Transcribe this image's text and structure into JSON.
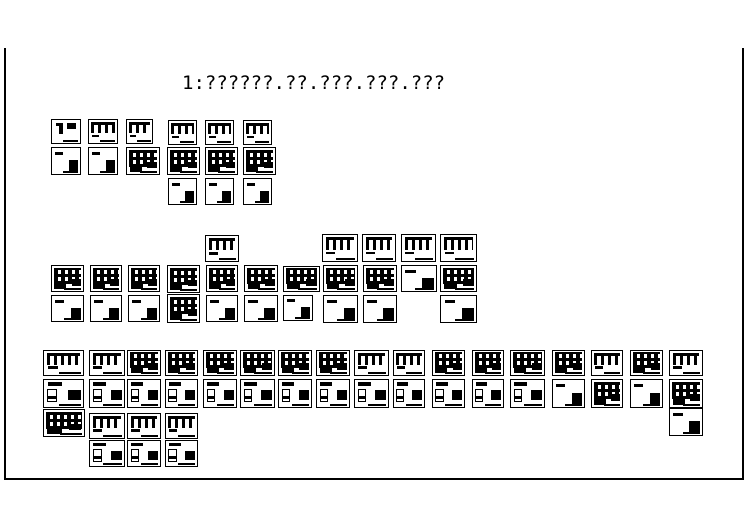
{
  "title": {
    "text": "1:??????.??.???.???.???"
  },
  "canvas": {
    "bg": "#ffffff",
    "line_color": "#000000"
  },
  "drawing": {
    "groups": [
      {
        "name": "group-1",
        "sheets": [
          {
            "x": 51,
            "y": 119,
            "w": 30,
            "h": 25,
            "v": "v5"
          },
          {
            "x": 88,
            "y": 119,
            "w": 30,
            "h": 25,
            "v": "v1"
          },
          {
            "x": 126,
            "y": 119,
            "w": 27,
            "h": 25,
            "v": "v1"
          },
          {
            "x": 168,
            "y": 120,
            "w": 29,
            "h": 25,
            "v": "v1"
          },
          {
            "x": 205,
            "y": 120,
            "w": 29,
            "h": 25,
            "v": "v1"
          },
          {
            "x": 243,
            "y": 120,
            "w": 29,
            "h": 25,
            "v": "v1"
          },
          {
            "x": 51,
            "y": 147,
            "w": 30,
            "h": 28,
            "v": "v3"
          },
          {
            "x": 88,
            "y": 147,
            "w": 30,
            "h": 28,
            "v": "v3"
          },
          {
            "x": 126,
            "y": 147,
            "w": 34,
            "h": 28,
            "v": "v2"
          },
          {
            "x": 167,
            "y": 147,
            "w": 33,
            "h": 28,
            "v": "v2"
          },
          {
            "x": 205,
            "y": 147,
            "w": 33,
            "h": 28,
            "v": "v2"
          },
          {
            "x": 243,
            "y": 147,
            "w": 33,
            "h": 28,
            "v": "v2"
          },
          {
            "x": 168,
            "y": 178,
            "w": 29,
            "h": 27,
            "v": "v3"
          },
          {
            "x": 205,
            "y": 178,
            "w": 29,
            "h": 27,
            "v": "v3"
          },
          {
            "x": 243,
            "y": 178,
            "w": 29,
            "h": 27,
            "v": "v3"
          }
        ]
      },
      {
        "name": "group-2",
        "sheets": [
          {
            "x": 205,
            "y": 235,
            "w": 34,
            "h": 27,
            "v": "v1"
          },
          {
            "x": 322,
            "y": 234,
            "w": 36,
            "h": 28,
            "v": "v1"
          },
          {
            "x": 362,
            "y": 234,
            "w": 34,
            "h": 28,
            "v": "v1"
          },
          {
            "x": 401,
            "y": 234,
            "w": 35,
            "h": 28,
            "v": "v1"
          },
          {
            "x": 440,
            "y": 234,
            "w": 37,
            "h": 28,
            "v": "v1"
          },
          {
            "x": 51,
            "y": 265,
            "w": 33,
            "h": 27,
            "v": "v2"
          },
          {
            "x": 90,
            "y": 265,
            "w": 32,
            "h": 27,
            "v": "v2"
          },
          {
            "x": 128,
            "y": 265,
            "w": 32,
            "h": 27,
            "v": "v2"
          },
          {
            "x": 167,
            "y": 265,
            "w": 33,
            "h": 28,
            "v": "v2"
          },
          {
            "x": 206,
            "y": 265,
            "w": 32,
            "h": 27,
            "v": "v2"
          },
          {
            "x": 244,
            "y": 265,
            "w": 34,
            "h": 27,
            "v": "v2"
          },
          {
            "x": 283,
            "y": 266,
            "w": 37,
            "h": 26,
            "v": "v2"
          },
          {
            "x": 323,
            "y": 265,
            "w": 35,
            "h": 27,
            "v": "v2"
          },
          {
            "x": 363,
            "y": 265,
            "w": 34,
            "h": 27,
            "v": "v2"
          },
          {
            "x": 401,
            "y": 265,
            "w": 36,
            "h": 27,
            "v": "v3"
          },
          {
            "x": 440,
            "y": 265,
            "w": 37,
            "h": 27,
            "v": "v2"
          },
          {
            "x": 51,
            "y": 295,
            "w": 33,
            "h": 27,
            "v": "v3"
          },
          {
            "x": 90,
            "y": 295,
            "w": 32,
            "h": 27,
            "v": "v3"
          },
          {
            "x": 128,
            "y": 295,
            "w": 32,
            "h": 27,
            "v": "v3"
          },
          {
            "x": 167,
            "y": 294,
            "w": 33,
            "h": 29,
            "v": "v2"
          },
          {
            "x": 206,
            "y": 295,
            "w": 32,
            "h": 27,
            "v": "v3"
          },
          {
            "x": 244,
            "y": 295,
            "w": 34,
            "h": 27,
            "v": "v3"
          },
          {
            "x": 283,
            "y": 295,
            "w": 30,
            "h": 26,
            "v": "v3"
          },
          {
            "x": 323,
            "y": 295,
            "w": 35,
            "h": 28,
            "v": "v3"
          },
          {
            "x": 363,
            "y": 295,
            "w": 34,
            "h": 28,
            "v": "v3"
          },
          {
            "x": 440,
            "y": 295,
            "w": 37,
            "h": 28,
            "v": "v3"
          }
        ]
      },
      {
        "name": "group-3",
        "sheets": [
          {
            "x": 43,
            "y": 350,
            "w": 41,
            "h": 26,
            "v": "v1"
          },
          {
            "x": 89,
            "y": 350,
            "w": 36,
            "h": 26,
            "v": "v1"
          },
          {
            "x": 127,
            "y": 350,
            "w": 34,
            "h": 26,
            "v": "v2"
          },
          {
            "x": 165,
            "y": 350,
            "w": 33,
            "h": 26,
            "v": "v2"
          },
          {
            "x": 203,
            "y": 350,
            "w": 34,
            "h": 26,
            "v": "v2"
          },
          {
            "x": 240,
            "y": 350,
            "w": 35,
            "h": 26,
            "v": "v2"
          },
          {
            "x": 278,
            "y": 350,
            "w": 34,
            "h": 26,
            "v": "v2"
          },
          {
            "x": 316,
            "y": 350,
            "w": 34,
            "h": 26,
            "v": "v2"
          },
          {
            "x": 354,
            "y": 350,
            "w": 35,
            "h": 26,
            "v": "v1"
          },
          {
            "x": 393,
            "y": 350,
            "w": 32,
            "h": 26,
            "v": "v1"
          },
          {
            "x": 432,
            "y": 350,
            "w": 33,
            "h": 26,
            "v": "v2"
          },
          {
            "x": 472,
            "y": 350,
            "w": 32,
            "h": 26,
            "v": "v2"
          },
          {
            "x": 510,
            "y": 350,
            "w": 35,
            "h": 26,
            "v": "v2"
          },
          {
            "x": 552,
            "y": 350,
            "w": 33,
            "h": 26,
            "v": "v2"
          },
          {
            "x": 591,
            "y": 350,
            "w": 32,
            "h": 26,
            "v": "v1"
          },
          {
            "x": 630,
            "y": 350,
            "w": 33,
            "h": 26,
            "v": "v2"
          },
          {
            "x": 669,
            "y": 350,
            "w": 34,
            "h": 26,
            "v": "v1"
          },
          {
            "x": 43,
            "y": 379,
            "w": 41,
            "h": 29,
            "v": "v4"
          },
          {
            "x": 89,
            "y": 379,
            "w": 36,
            "h": 29,
            "v": "v4"
          },
          {
            "x": 127,
            "y": 379,
            "w": 34,
            "h": 29,
            "v": "v4"
          },
          {
            "x": 165,
            "y": 379,
            "w": 33,
            "h": 29,
            "v": "v4"
          },
          {
            "x": 203,
            "y": 379,
            "w": 34,
            "h": 29,
            "v": "v4"
          },
          {
            "x": 240,
            "y": 379,
            "w": 35,
            "h": 29,
            "v": "v4"
          },
          {
            "x": 278,
            "y": 379,
            "w": 34,
            "h": 29,
            "v": "v4"
          },
          {
            "x": 316,
            "y": 379,
            "w": 34,
            "h": 29,
            "v": "v4"
          },
          {
            "x": 354,
            "y": 379,
            "w": 35,
            "h": 29,
            "v": "v4"
          },
          {
            "x": 393,
            "y": 379,
            "w": 32,
            "h": 29,
            "v": "v4"
          },
          {
            "x": 432,
            "y": 379,
            "w": 33,
            "h": 29,
            "v": "v4"
          },
          {
            "x": 472,
            "y": 379,
            "w": 32,
            "h": 29,
            "v": "v4"
          },
          {
            "x": 510,
            "y": 379,
            "w": 35,
            "h": 29,
            "v": "v4"
          },
          {
            "x": 552,
            "y": 379,
            "w": 33,
            "h": 29,
            "v": "v3"
          },
          {
            "x": 591,
            "y": 379,
            "w": 32,
            "h": 29,
            "v": "v2"
          },
          {
            "x": 630,
            "y": 379,
            "w": 33,
            "h": 29,
            "v": "v3"
          },
          {
            "x": 669,
            "y": 379,
            "w": 34,
            "h": 29,
            "v": "v2"
          },
          {
            "x": 43,
            "y": 409,
            "w": 42,
            "h": 28,
            "v": "v2"
          },
          {
            "x": 89,
            "y": 413,
            "w": 36,
            "h": 26,
            "v": "v1"
          },
          {
            "x": 127,
            "y": 413,
            "w": 34,
            "h": 26,
            "v": "v1"
          },
          {
            "x": 165,
            "y": 413,
            "w": 33,
            "h": 26,
            "v": "v1"
          },
          {
            "x": 669,
            "y": 408,
            "w": 34,
            "h": 28,
            "v": "v3"
          },
          {
            "x": 89,
            "y": 440,
            "w": 36,
            "h": 27,
            "v": "v4"
          },
          {
            "x": 127,
            "y": 440,
            "w": 34,
            "h": 27,
            "v": "v4"
          },
          {
            "x": 165,
            "y": 440,
            "w": 33,
            "h": 27,
            "v": "v4"
          }
        ]
      }
    ]
  }
}
